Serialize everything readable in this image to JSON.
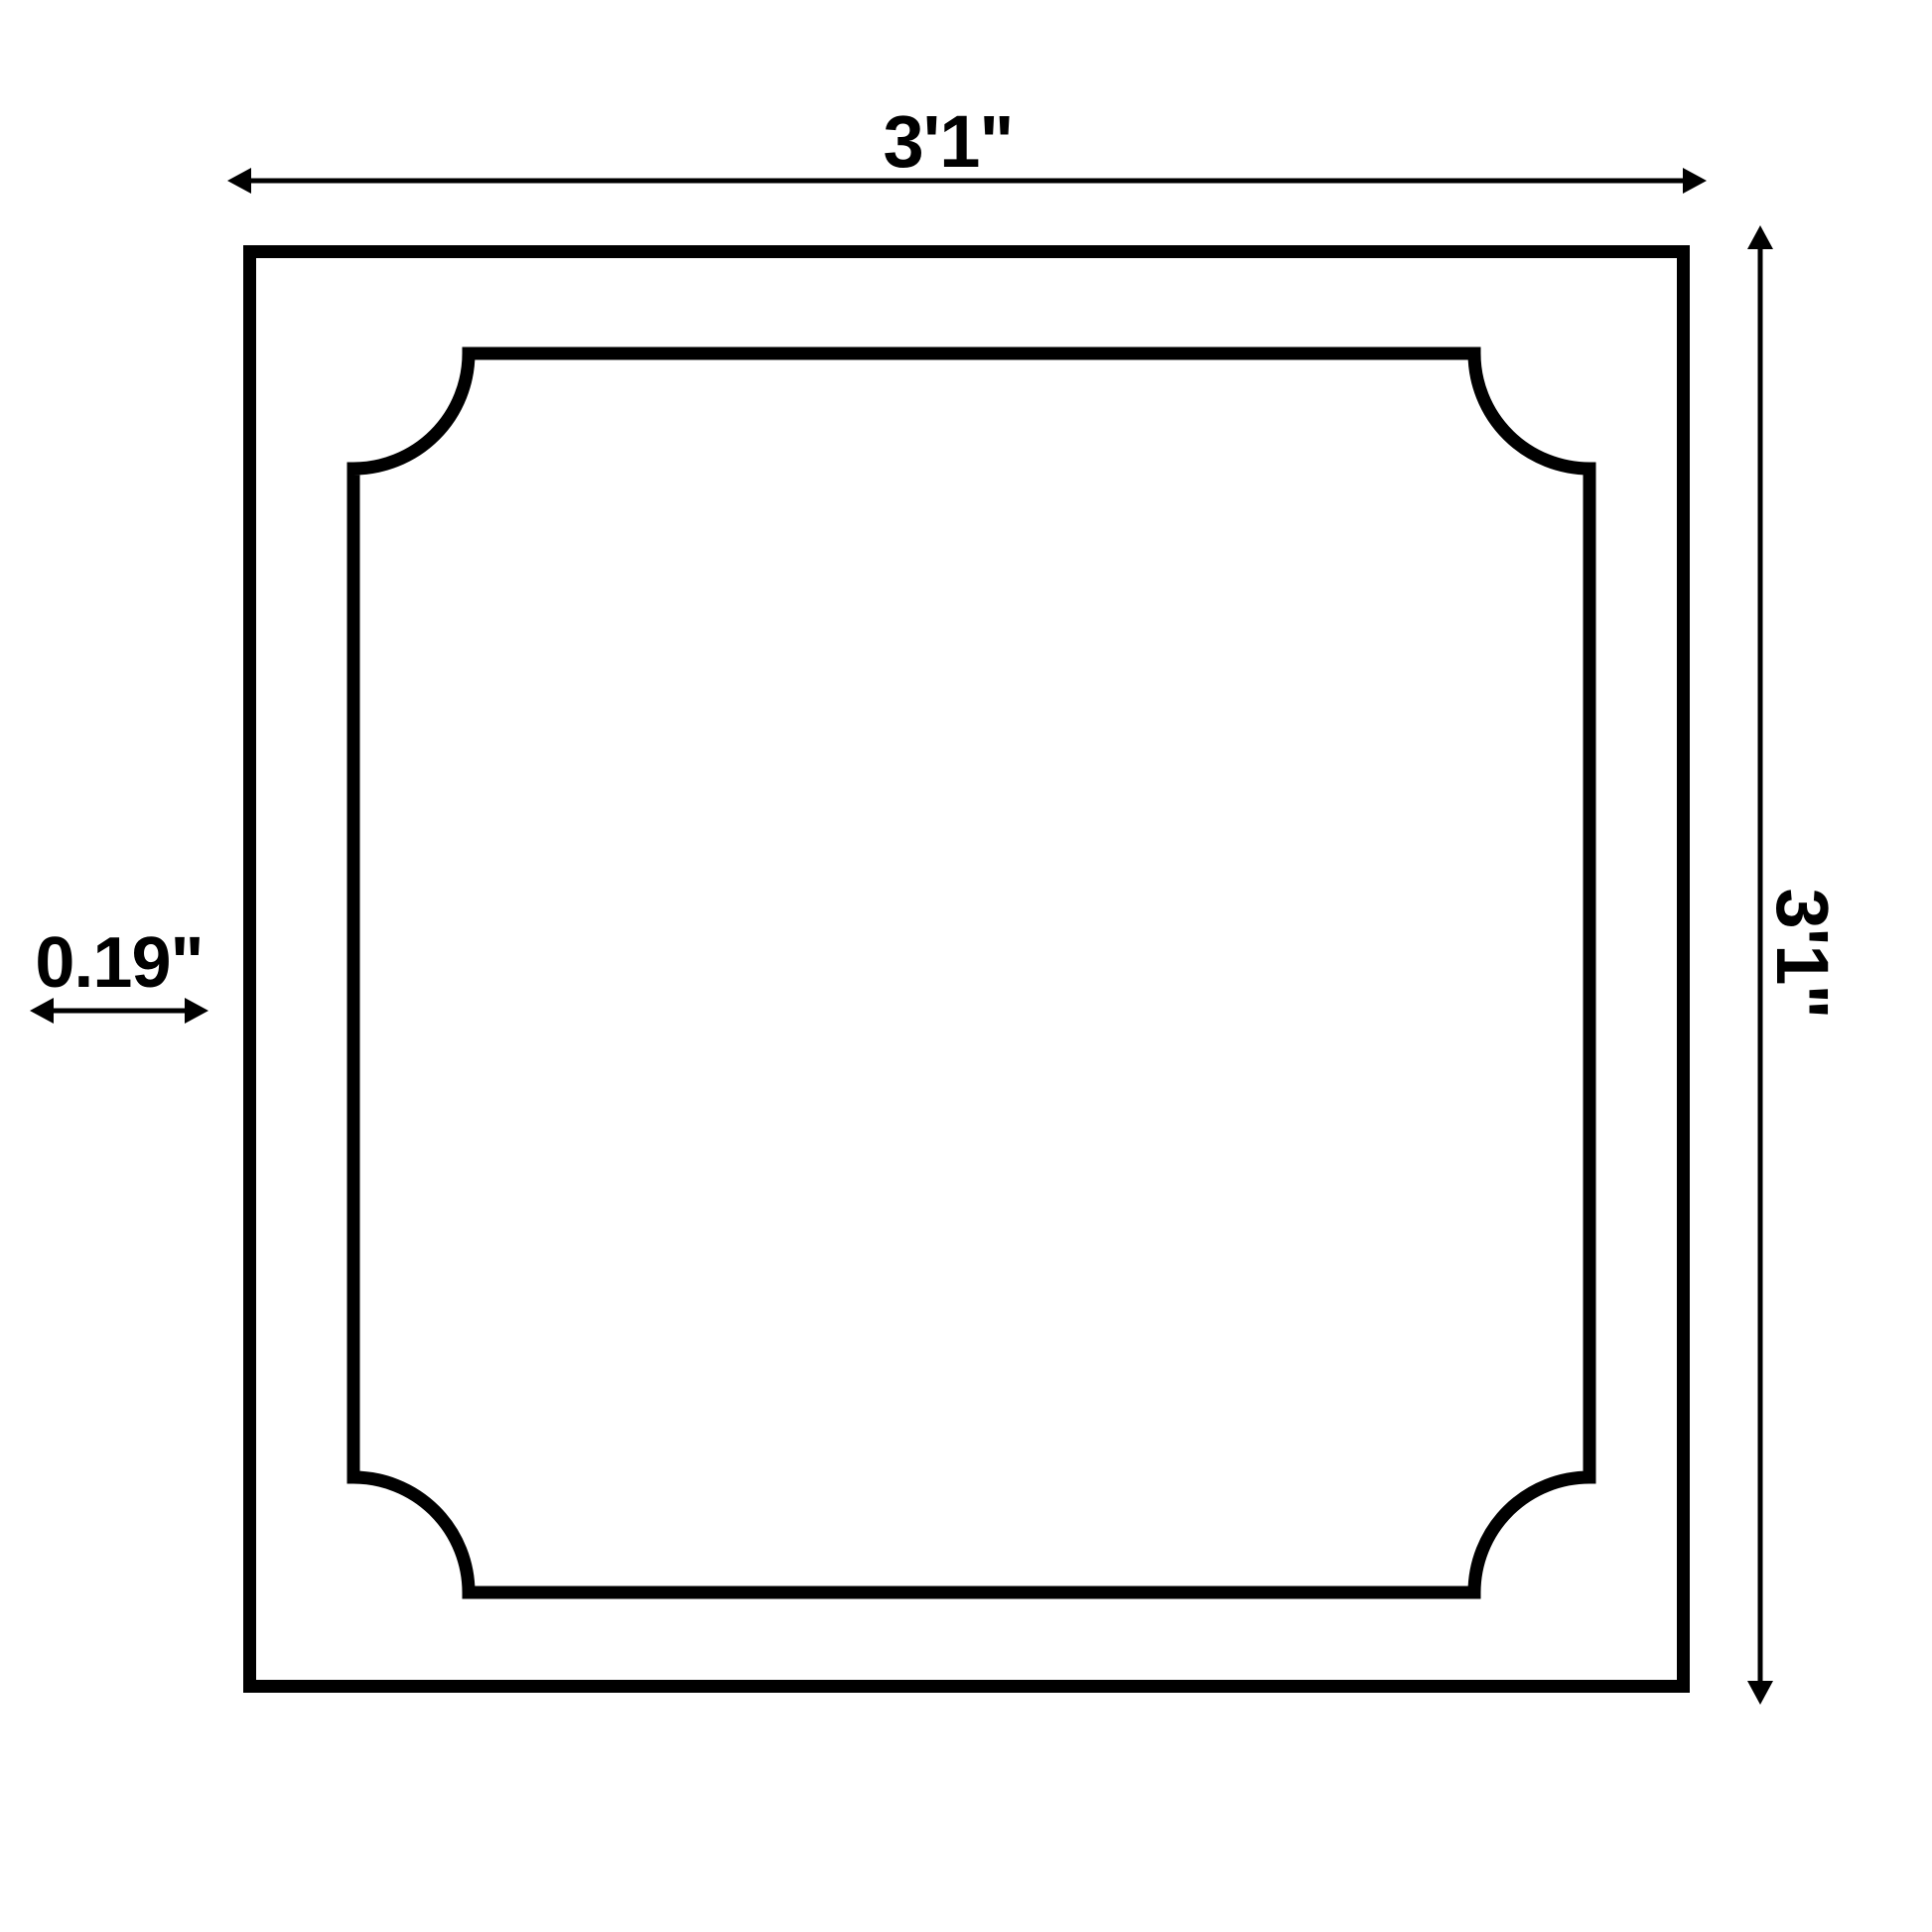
{
  "diagram": {
    "labels": {
      "width": "3'1\"",
      "height": "3'1\"",
      "thickness": "0.19\""
    },
    "colors": {
      "line": "#000000",
      "background": "#ffffff"
    }
  }
}
